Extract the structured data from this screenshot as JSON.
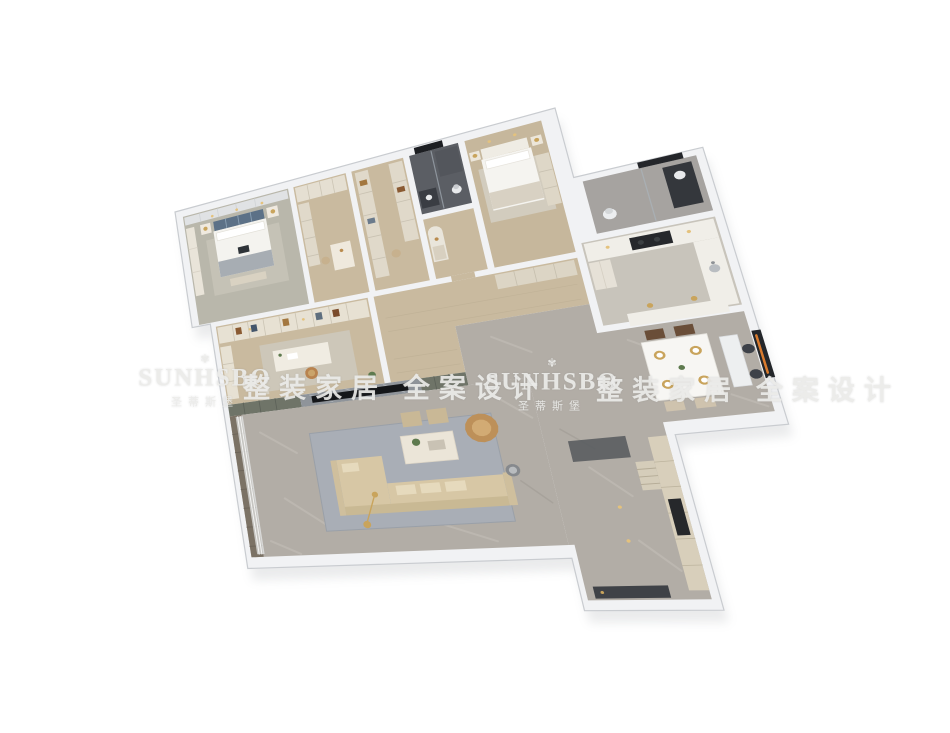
{
  "canvas": {
    "width": 950,
    "height": 733,
    "background": "#ffffff"
  },
  "watermark": {
    "logo_glyph": "✾",
    "brand_latin": "SUNHSBO",
    "brand_chinese": "圣蒂斯堡",
    "slogan_chinese": "整装家居 全案设计",
    "text_color": "#ebebe9",
    "instances": [
      {
        "kind": "brand",
        "x": 205,
        "y": 382
      },
      {
        "kind": "slogan",
        "x": 395,
        "y": 386
      },
      {
        "kind": "brand",
        "x": 552,
        "y": 386
      },
      {
        "kind": "slogan",
        "x": 748,
        "y": 388
      }
    ]
  },
  "palette": {
    "background": "#ffffff",
    "wall": "#f1f2f4",
    "wall_edge": "#c9ccd0",
    "wall_shadow": "#8e9398",
    "carpet": "#b9b7ab",
    "wood": "#c9ba9f",
    "wood2": "#c6b79c",
    "marble": "#b2ada6",
    "marble_feature": "#8f949a",
    "tile": "#a6a3a0",
    "dark_tile": "#5b5e64",
    "kitchen_floor": "#c8c4bb",
    "cabinet": "#d8cfbb",
    "counter": "#f0eee8",
    "sofa": "#d7c7a5",
    "accent_tan": "#bd9059",
    "accent_gold": "#c9a45c",
    "tv_black": "#141619",
    "olive_cabinet": "#6f7468",
    "rug_blue": "#a9aeb6",
    "dark_fixture": "#34373c"
  },
  "rooms": [
    {
      "name": "master-bedroom",
      "floor": "carpet"
    },
    {
      "name": "walk-in-closet",
      "floor": "wood"
    },
    {
      "name": "storage-closet",
      "floor": "wood"
    },
    {
      "name": "master-bathroom",
      "floor": "dark_tile"
    },
    {
      "name": "inner-hallway",
      "floor": "wood"
    },
    {
      "name": "bedroom-2",
      "floor": "wood2"
    },
    {
      "name": "bathroom-2",
      "floor": "tile"
    },
    {
      "name": "kitchen",
      "floor": "kitchen_floor"
    },
    {
      "name": "corridor",
      "floor": "wood"
    },
    {
      "name": "study",
      "floor": "wood"
    },
    {
      "name": "tv-feature-wall",
      "floor": "marble_feature"
    },
    {
      "name": "living-room",
      "floor": "marble"
    },
    {
      "name": "open-plan-area",
      "floor": "marble"
    },
    {
      "name": "dining-room",
      "floor": "marble"
    },
    {
      "name": "entry-hallway",
      "floor": "marble"
    }
  ]
}
